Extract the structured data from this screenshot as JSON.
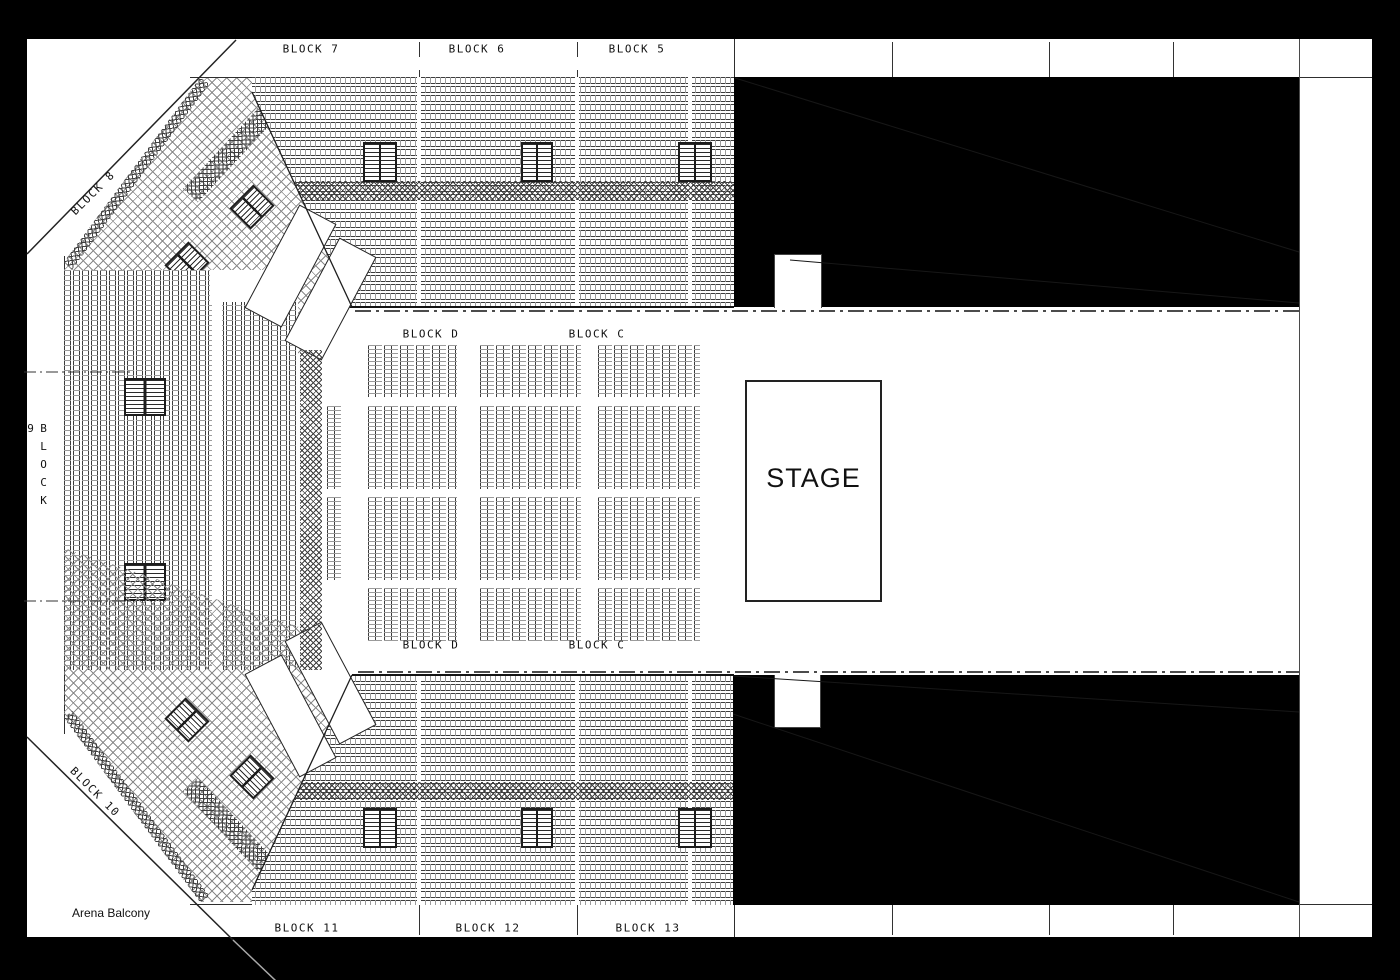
{
  "colors": {
    "background": "#000000",
    "page": "#ffffff",
    "line": "#222222",
    "blocked_out": "#000000"
  },
  "arena": {
    "top_tier_labels": [
      {
        "label": "BLOCK 7"
      },
      {
        "label": "BLOCK 6"
      },
      {
        "label": "BLOCK 5"
      }
    ],
    "bottom_tier_labels": [
      {
        "label": "BLOCK 11"
      },
      {
        "label": "BLOCK 12"
      },
      {
        "label": "BLOCK 13"
      }
    ],
    "left_top_label": "BLOCK 8",
    "left_label": "BLOCK 9",
    "left_bottom_label": "BLOCK 10",
    "floor_top_labels": [
      {
        "label": "BLOCK D"
      },
      {
        "label": "BLOCK C"
      }
    ],
    "floor_bottom_labels": [
      {
        "label": "BLOCK D"
      },
      {
        "label": "BLOCK C"
      }
    ],
    "stage_label": "STAGE",
    "balcony_label": "Arena Balcony"
  }
}
